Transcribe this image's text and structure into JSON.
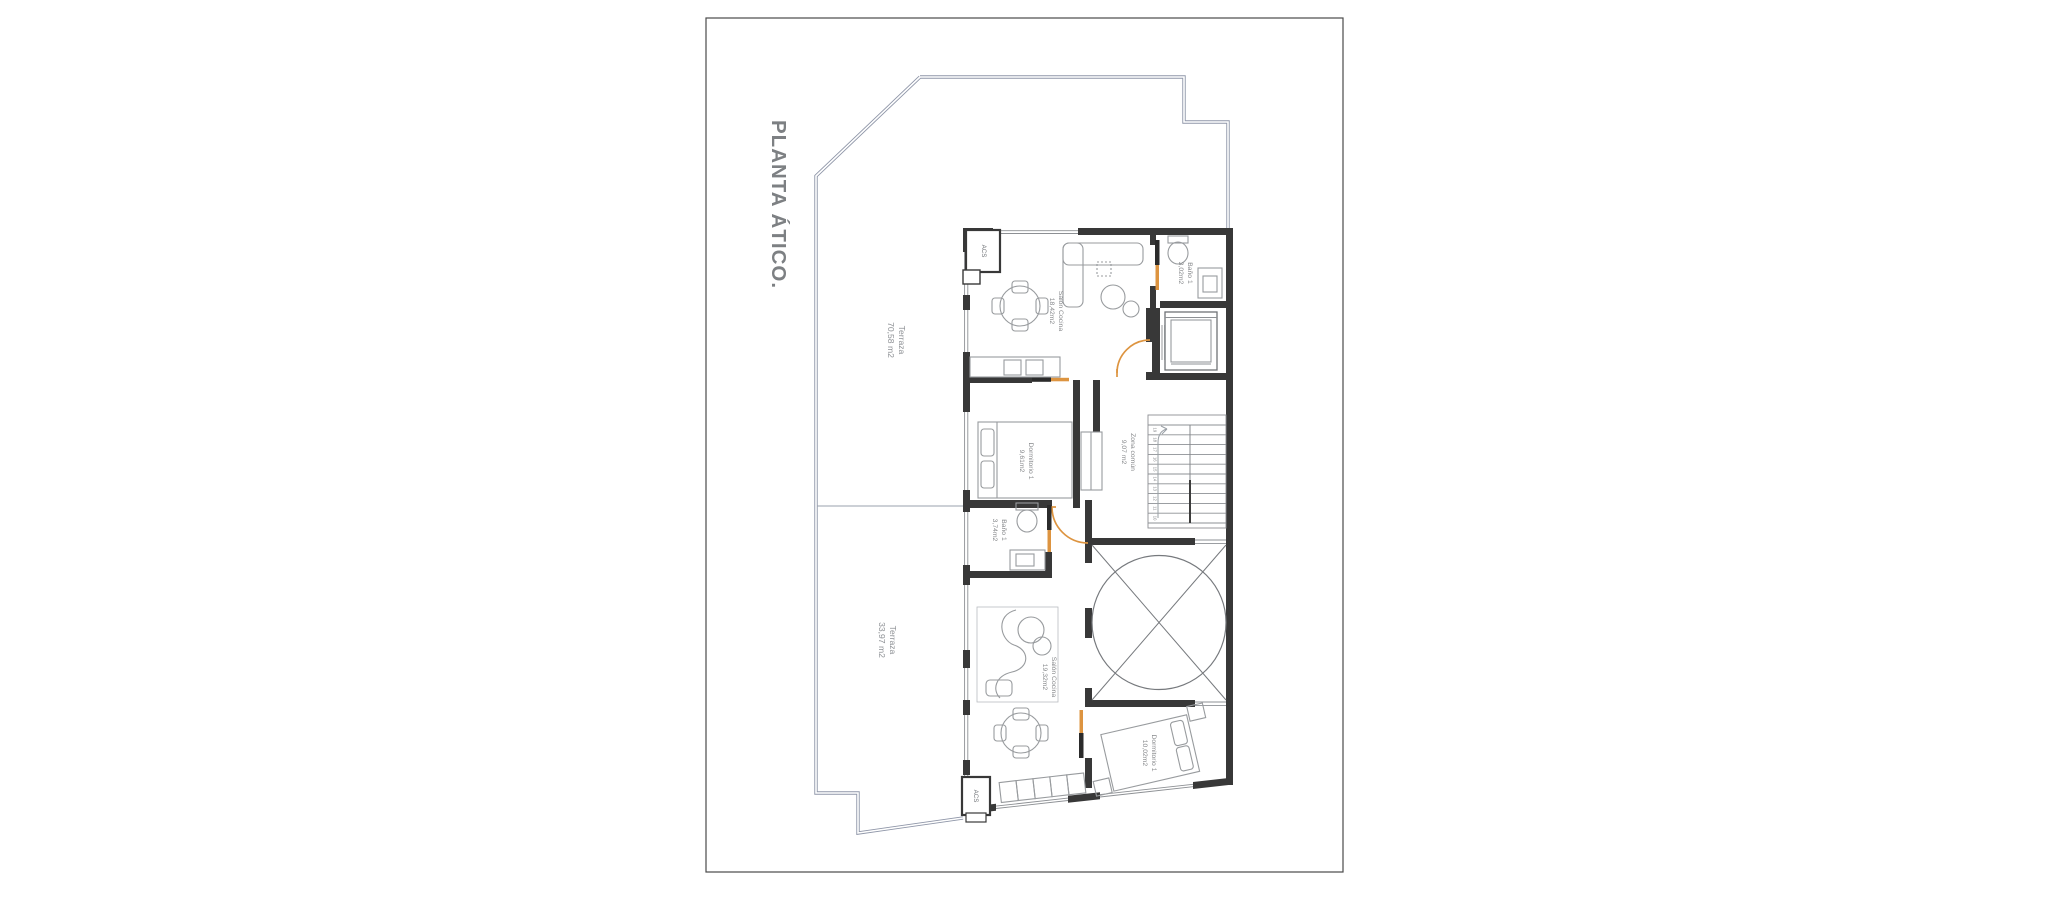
{
  "drawing": {
    "title": "PLANTA ÁTICO.",
    "rooms": {
      "terraza_upper": {
        "name": "Terraza",
        "area": "70,58 m2"
      },
      "terraza_lower": {
        "name": "Terraza",
        "area": "33,97 m2"
      },
      "salon_upper": {
        "name": "Salón Cocina",
        "area": "18,42m2"
      },
      "bano_upper": {
        "name": "Baño 1",
        "area": "3,02m2"
      },
      "dormitorio_upper": {
        "name": "Dormitorio 1",
        "area": "9,61m2"
      },
      "zona_comun": {
        "name": "Zona común",
        "area": "9,07 m2"
      },
      "bano_lower": {
        "name": "Baño 1",
        "area": "3,74m2"
      },
      "salon_lower": {
        "name": "Salón Cocina",
        "area": "19,32m2"
      },
      "dormitorio_lower": {
        "name": "Dormitorio 1",
        "area": "10,02m2"
      },
      "acs_upper": {
        "name": "ACS"
      },
      "acs_lower": {
        "name": "ACS"
      }
    },
    "stairs": {
      "treads": [
        "19",
        "18",
        "17",
        "16",
        "15",
        "14",
        "13",
        "12",
        "11",
        "10"
      ]
    },
    "colors": {
      "wall": "#383838",
      "door_accent": "#dd9440",
      "door_leaf_dark": "#2b2b2b",
      "terrace_outline": "#8f96a8",
      "label_text": "#85878a",
      "title_text": "#7d8083"
    }
  }
}
